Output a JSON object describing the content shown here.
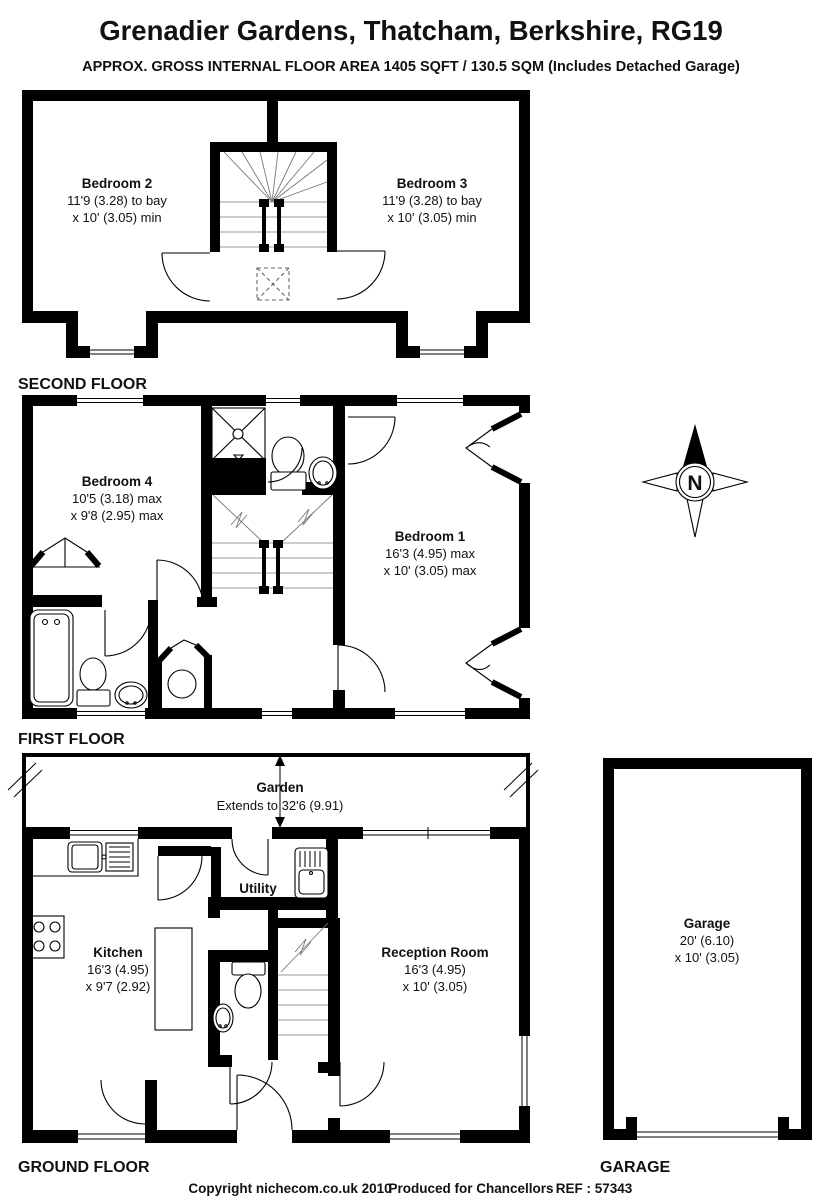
{
  "title": "Grenadier Gardens, Thatcham, Berkshire, RG19",
  "subtitle": "APPROX. GROSS INTERNAL FLOOR AREA 1405 SQFT / 130.5 SQM (Includes Detached Garage)",
  "second_floor": {
    "label": "SECOND FLOOR",
    "bedroom2": {
      "name": "Bedroom 2",
      "dim1": "11'9 (3.28) to bay",
      "dim2": "x 10' (3.05) min"
    },
    "bedroom3": {
      "name": "Bedroom 3",
      "dim1": "11'9 (3.28) to bay",
      "dim2": "x 10' (3.05) min"
    }
  },
  "first_floor": {
    "label": "FIRST FLOOR",
    "bedroom4": {
      "name": "Bedroom 4",
      "dim1": "10'5 (3.18) max",
      "dim2": "x 9'8 (2.95) max"
    },
    "bedroom1": {
      "name": "Bedroom 1",
      "dim1": "16'3 (4.95) max",
      "dim2": "x 10' (3.05) max"
    }
  },
  "ground_floor": {
    "label": "GROUND FLOOR",
    "garden": {
      "name": "Garden",
      "dim": "Extends to 32'6 (9.91)"
    },
    "kitchen": {
      "name": "Kitchen",
      "dim1": "16'3 (4.95)",
      "dim2": "x 9'7 (2.92)"
    },
    "utility": {
      "name": "Utility"
    },
    "reception": {
      "name": "Reception Room",
      "dim1": "16'3 (4.95)",
      "dim2": "x 10' (3.05)"
    }
  },
  "garage": {
    "label": "GARAGE",
    "name": "Garage",
    "dim1": "20' (6.10)",
    "dim2": "x 10' (3.05)"
  },
  "compass": {
    "north": "N"
  },
  "footer": {
    "copyright": "Copyright nichecom.co.uk 2010",
    "produced": "Produced for Chancellors",
    "reference": "REF : 57343"
  }
}
